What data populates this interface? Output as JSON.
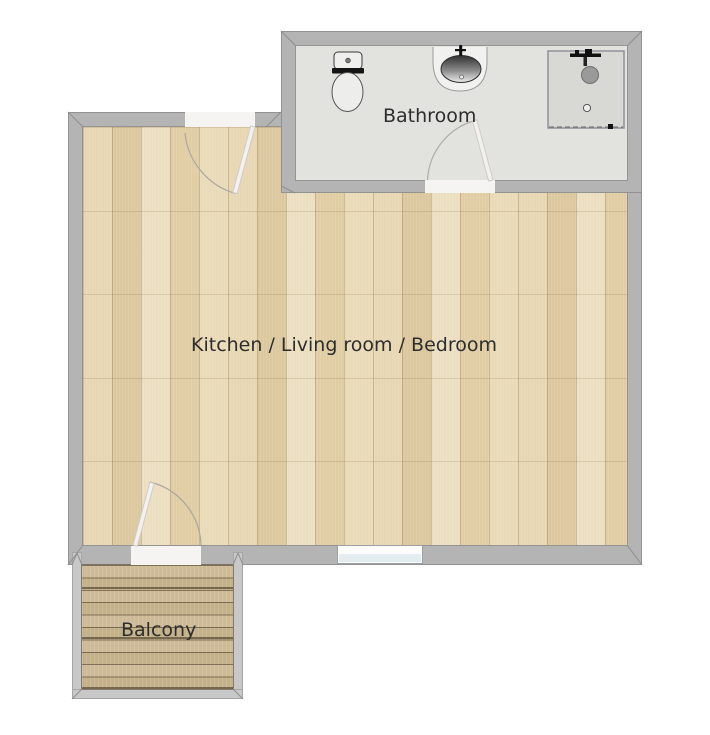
{
  "canvas": {
    "width": 710,
    "height": 735,
    "background": "#ffffff"
  },
  "rooms": {
    "bathroom": {
      "label": "Bathroom"
    },
    "main": {
      "label": "Kitchen / Living room / Bedroom"
    },
    "balcony": {
      "label": "Balcony"
    }
  },
  "fixtures": [
    {
      "name": "toilet"
    },
    {
      "name": "sink"
    },
    {
      "name": "shower"
    }
  ],
  "doors": [
    {
      "name": "entrance-door"
    },
    {
      "name": "bathroom-door"
    },
    {
      "name": "balcony-door"
    }
  ],
  "windows": [
    {
      "name": "main-room-window"
    }
  ],
  "colors": {
    "wall": "#b4b4b4",
    "balcony_wall": "#c8c8c8",
    "wood_floor": "#e3d2ab",
    "deck": "#c9b791",
    "bathroom_floor": "#e2e2de",
    "label_text": "#2d2d2d",
    "door_leaf": "#f2f1ee",
    "window_glass": "#e3edf1"
  }
}
